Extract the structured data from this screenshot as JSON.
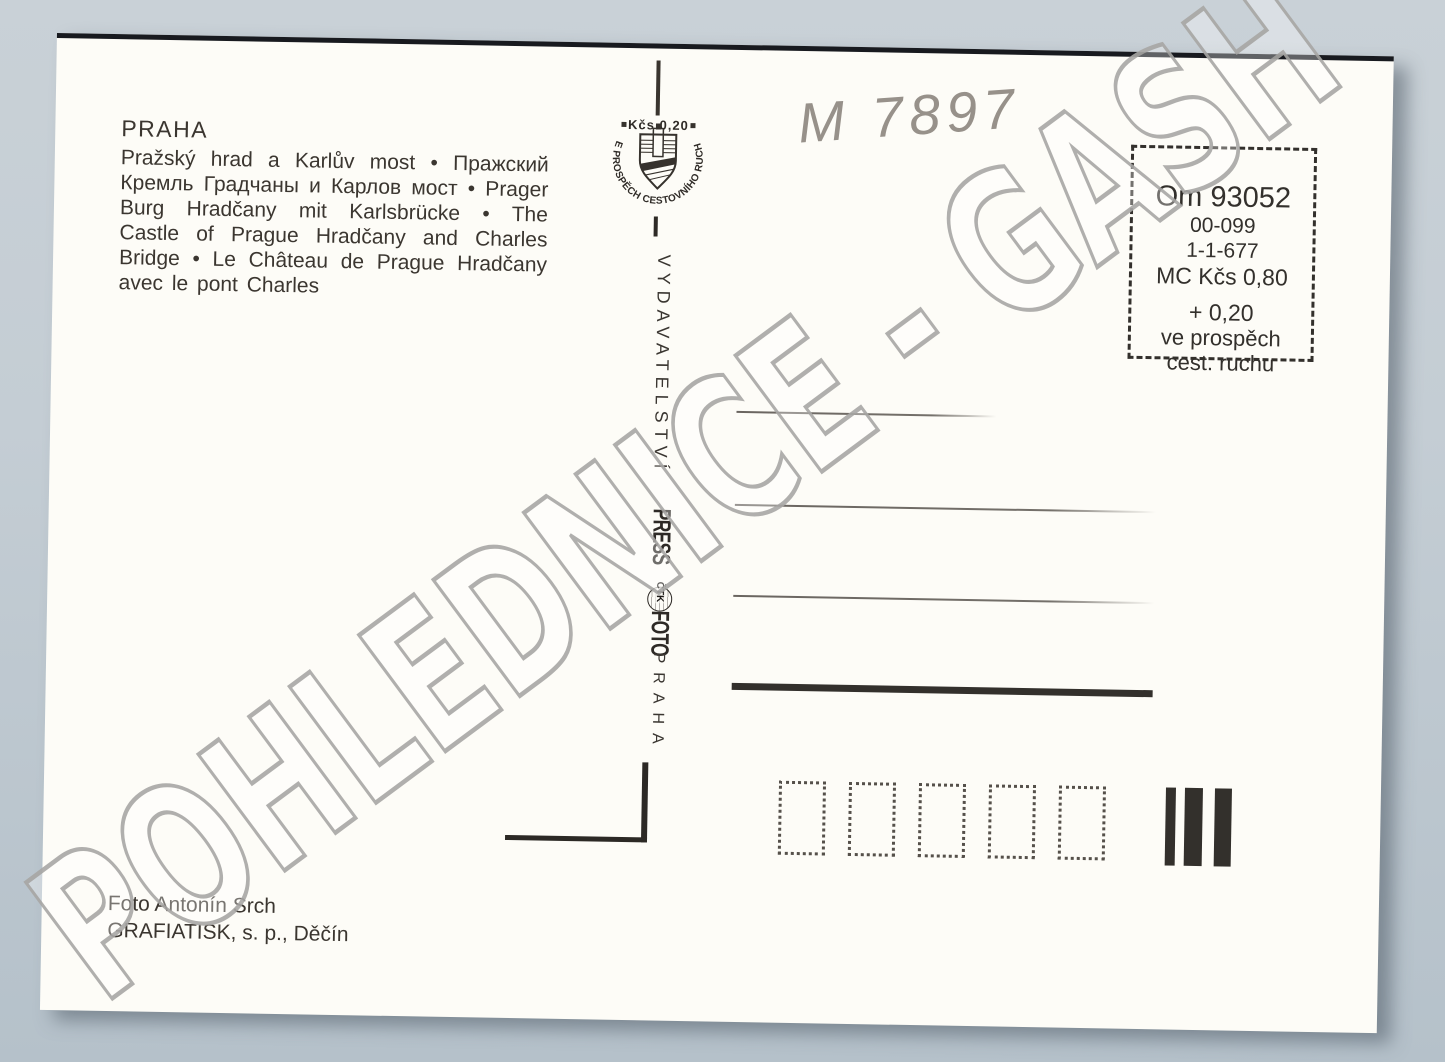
{
  "colors": {
    "scan_background": "#c3ccd3",
    "card": "#fdfcf7",
    "ink": "#36322d",
    "watermark_gray": "#a8a7a5",
    "pencil_gray": "#8c867f"
  },
  "card": {
    "title": "PRAHA",
    "caption": "Pražský hrad a Karlův most • Пражский Кремль Градчаны и Карлов мост • Prager Burg Hradčany mit Karlsbrücke • The Castle of Prague Hradčany and Charles Bridge • Le Château de Prague Hradčany avec le pont Charles",
    "handwritten_number": "M 7897",
    "stamp_emblem": {
      "price": "Kčs 0,20",
      "ring_text": "VE PROSPĚCH CESTOVNÍHO RUCHU"
    },
    "price_box": {
      "lines": [
        "Om 93052",
        "00-099",
        "1-1-677",
        "MC Kčs 0,80",
        "+ 0,20",
        "ve prospěch",
        "cest. ruchu"
      ]
    },
    "divider": {
      "publisher": "VYDAVATELSTVÍ",
      "press": "PRESS",
      "agency": "ČTK",
      "foto": "FOTO",
      "city": "PRAHA"
    },
    "credits": {
      "photographer": "Foto Antonín Srch",
      "printer": "GRAFIATISK, s. p., Děčín"
    }
  },
  "watermark": {
    "text": "POHLEDNICE - GASH"
  }
}
